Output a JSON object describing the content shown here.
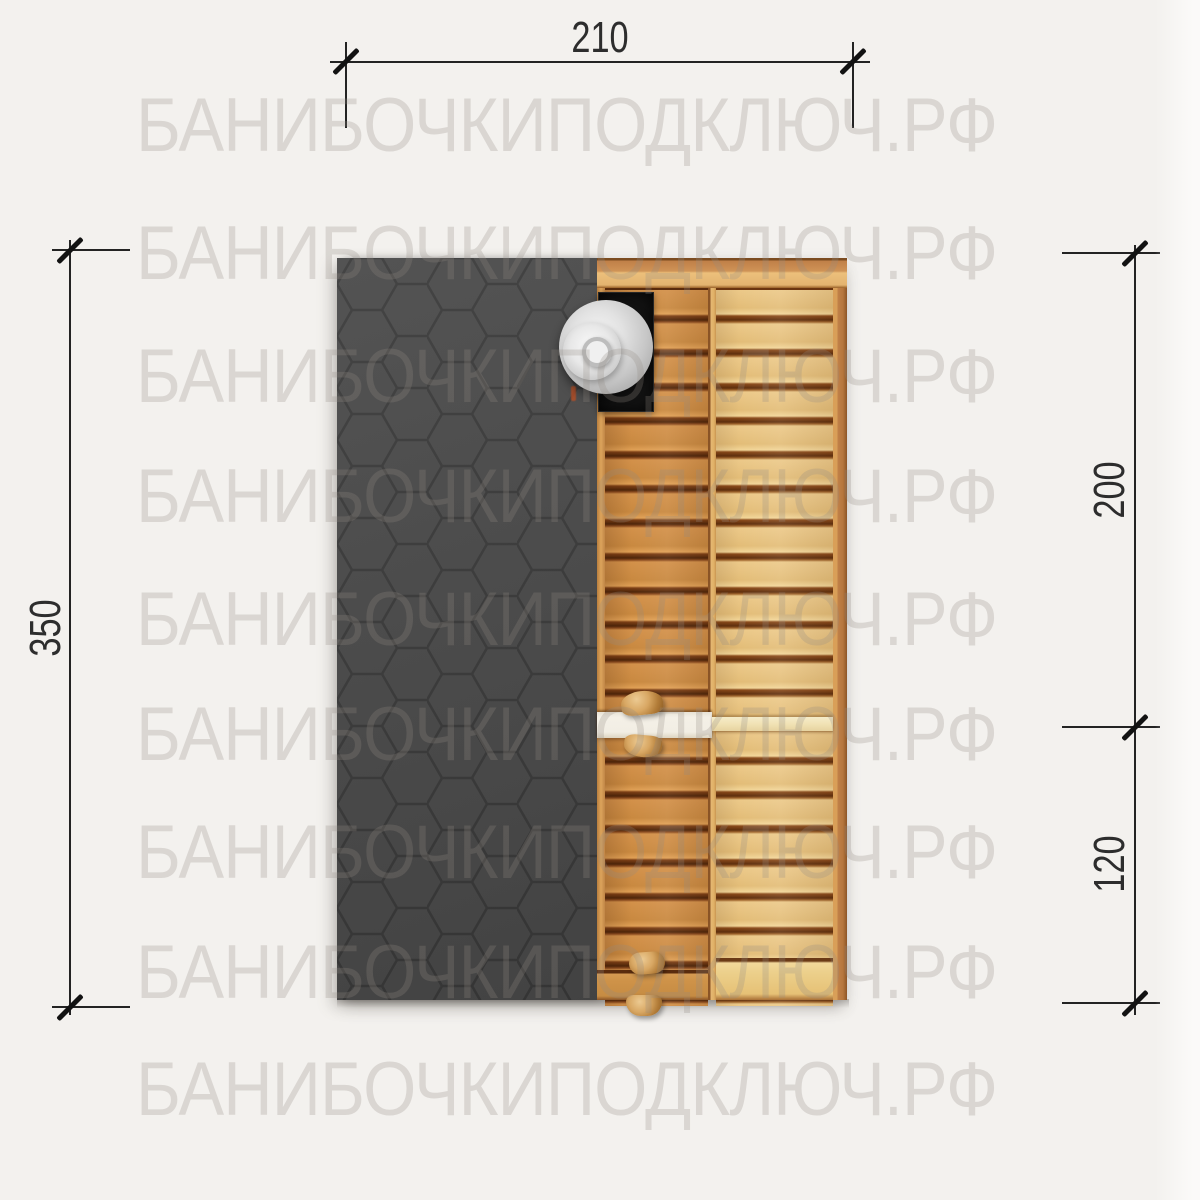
{
  "watermark": {
    "text": "БАНИБОЧКИПОДКЛЮЧ.РФ"
  },
  "dimensions": {
    "top": {
      "value": "210"
    },
    "left": {
      "value": "350"
    },
    "right_upper": {
      "value": "200"
    },
    "right_lower": {
      "value": "120"
    }
  },
  "parts": {
    "roof_left_half": "hexagonal-shingle-covering",
    "right_half": "wood-plank-deck",
    "chimney": "metal-chimney-cap-disc",
    "door_strip": "white-strip",
    "handles": "wooden-handles"
  },
  "colors": {
    "background": "#f3f1ee",
    "shingle": "#4a4a4a",
    "shingle_line": "#3a3a3a",
    "wood_door": "#d3914a",
    "wood_bench": "#ecc989",
    "wood_gap": "#4e2509",
    "metal_cap": "#d9d9d9",
    "dimension_line": "#232323"
  }
}
